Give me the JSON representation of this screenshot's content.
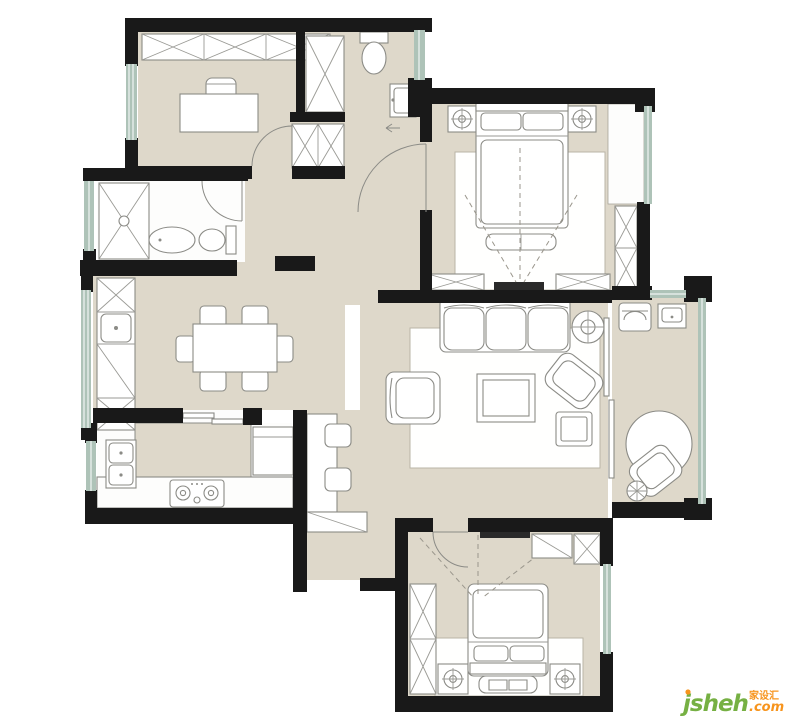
{
  "meta": {
    "title": "apartment-floor-plan",
    "type": "floor-plan",
    "canvas": {
      "width": 800,
      "height": 720
    },
    "text_labels_on_plan": "none"
  },
  "palette": {
    "background": "#ffffff",
    "wall": "#191919",
    "floor": "#ded8ca",
    "window": "#aec3b8",
    "furniture_line": "#8b8b86",
    "rug": "#fffffe"
  },
  "watermark": {
    "brand": "jsheh",
    "tld": ".com",
    "cjk": "家设汇",
    "brand_color": "#76b043",
    "accent_color": "#f7941d"
  },
  "rooms": [
    {
      "name": "study",
      "position": "top-left",
      "furniture": [
        "wardrobe-x-units",
        "desk",
        "desk-chair",
        "west-window"
      ]
    },
    {
      "name": "entry-foyer-wc",
      "position": "top-center",
      "furniture": [
        "toilet",
        "entry-door",
        "entry-arrow",
        "east-window",
        "hall-closet-upper",
        "hall-closet-lower"
      ]
    },
    {
      "name": "master-bedroom",
      "position": "top-right",
      "furniture": [
        "double-bed",
        "pillows",
        "nightstand-left",
        "nightstand-right",
        "bedside-lamps",
        "foot-bench",
        "area-rug",
        "tv-cabinet-left",
        "tv-cabinet-right",
        "wall-tv",
        "wardrobe",
        "bay-window",
        "tv-sightlines"
      ]
    },
    {
      "name": "bathroom",
      "position": "mid-left",
      "furniture": [
        "shower",
        "vanity-basin",
        "toilet",
        "west-light-window",
        "swing-door"
      ]
    },
    {
      "name": "dining-room",
      "position": "center-left",
      "furniture": [
        "dining-table",
        "six-chairs",
        "sideboard-with-sink",
        "west-window"
      ]
    },
    {
      "name": "kitchen",
      "position": "bottom-left",
      "furniture": [
        "counter",
        "refrigerator",
        "double-sink",
        "cooktop",
        "sliding-door",
        "west-window"
      ]
    },
    {
      "name": "work-nook",
      "position": "center",
      "furniture": [
        "desk",
        "two-chairs",
        "low-cabinet"
      ]
    },
    {
      "name": "living-room",
      "position": "center-right",
      "furniture": [
        "three-seat-sofa",
        "coffee-table",
        "armchair",
        "lounge-chair",
        "side-table",
        "pendant-lamp",
        "area-rug",
        "balcony-slider"
      ]
    },
    {
      "name": "balcony",
      "position": "right",
      "furniture": [
        "washing-machine",
        "laundry-sink",
        "round-table",
        "lounge-chair",
        "plant",
        "east-window"
      ]
    },
    {
      "name": "bedroom-2",
      "position": "bottom-center",
      "furniture": [
        "double-bed",
        "pillows",
        "nightstand-left",
        "nightstand-right",
        "foot-bench",
        "wardrobe",
        "wall-tv",
        "cabinets",
        "area-rug",
        "east-window",
        "swing-door",
        "tv-sightlines"
      ]
    }
  ]
}
